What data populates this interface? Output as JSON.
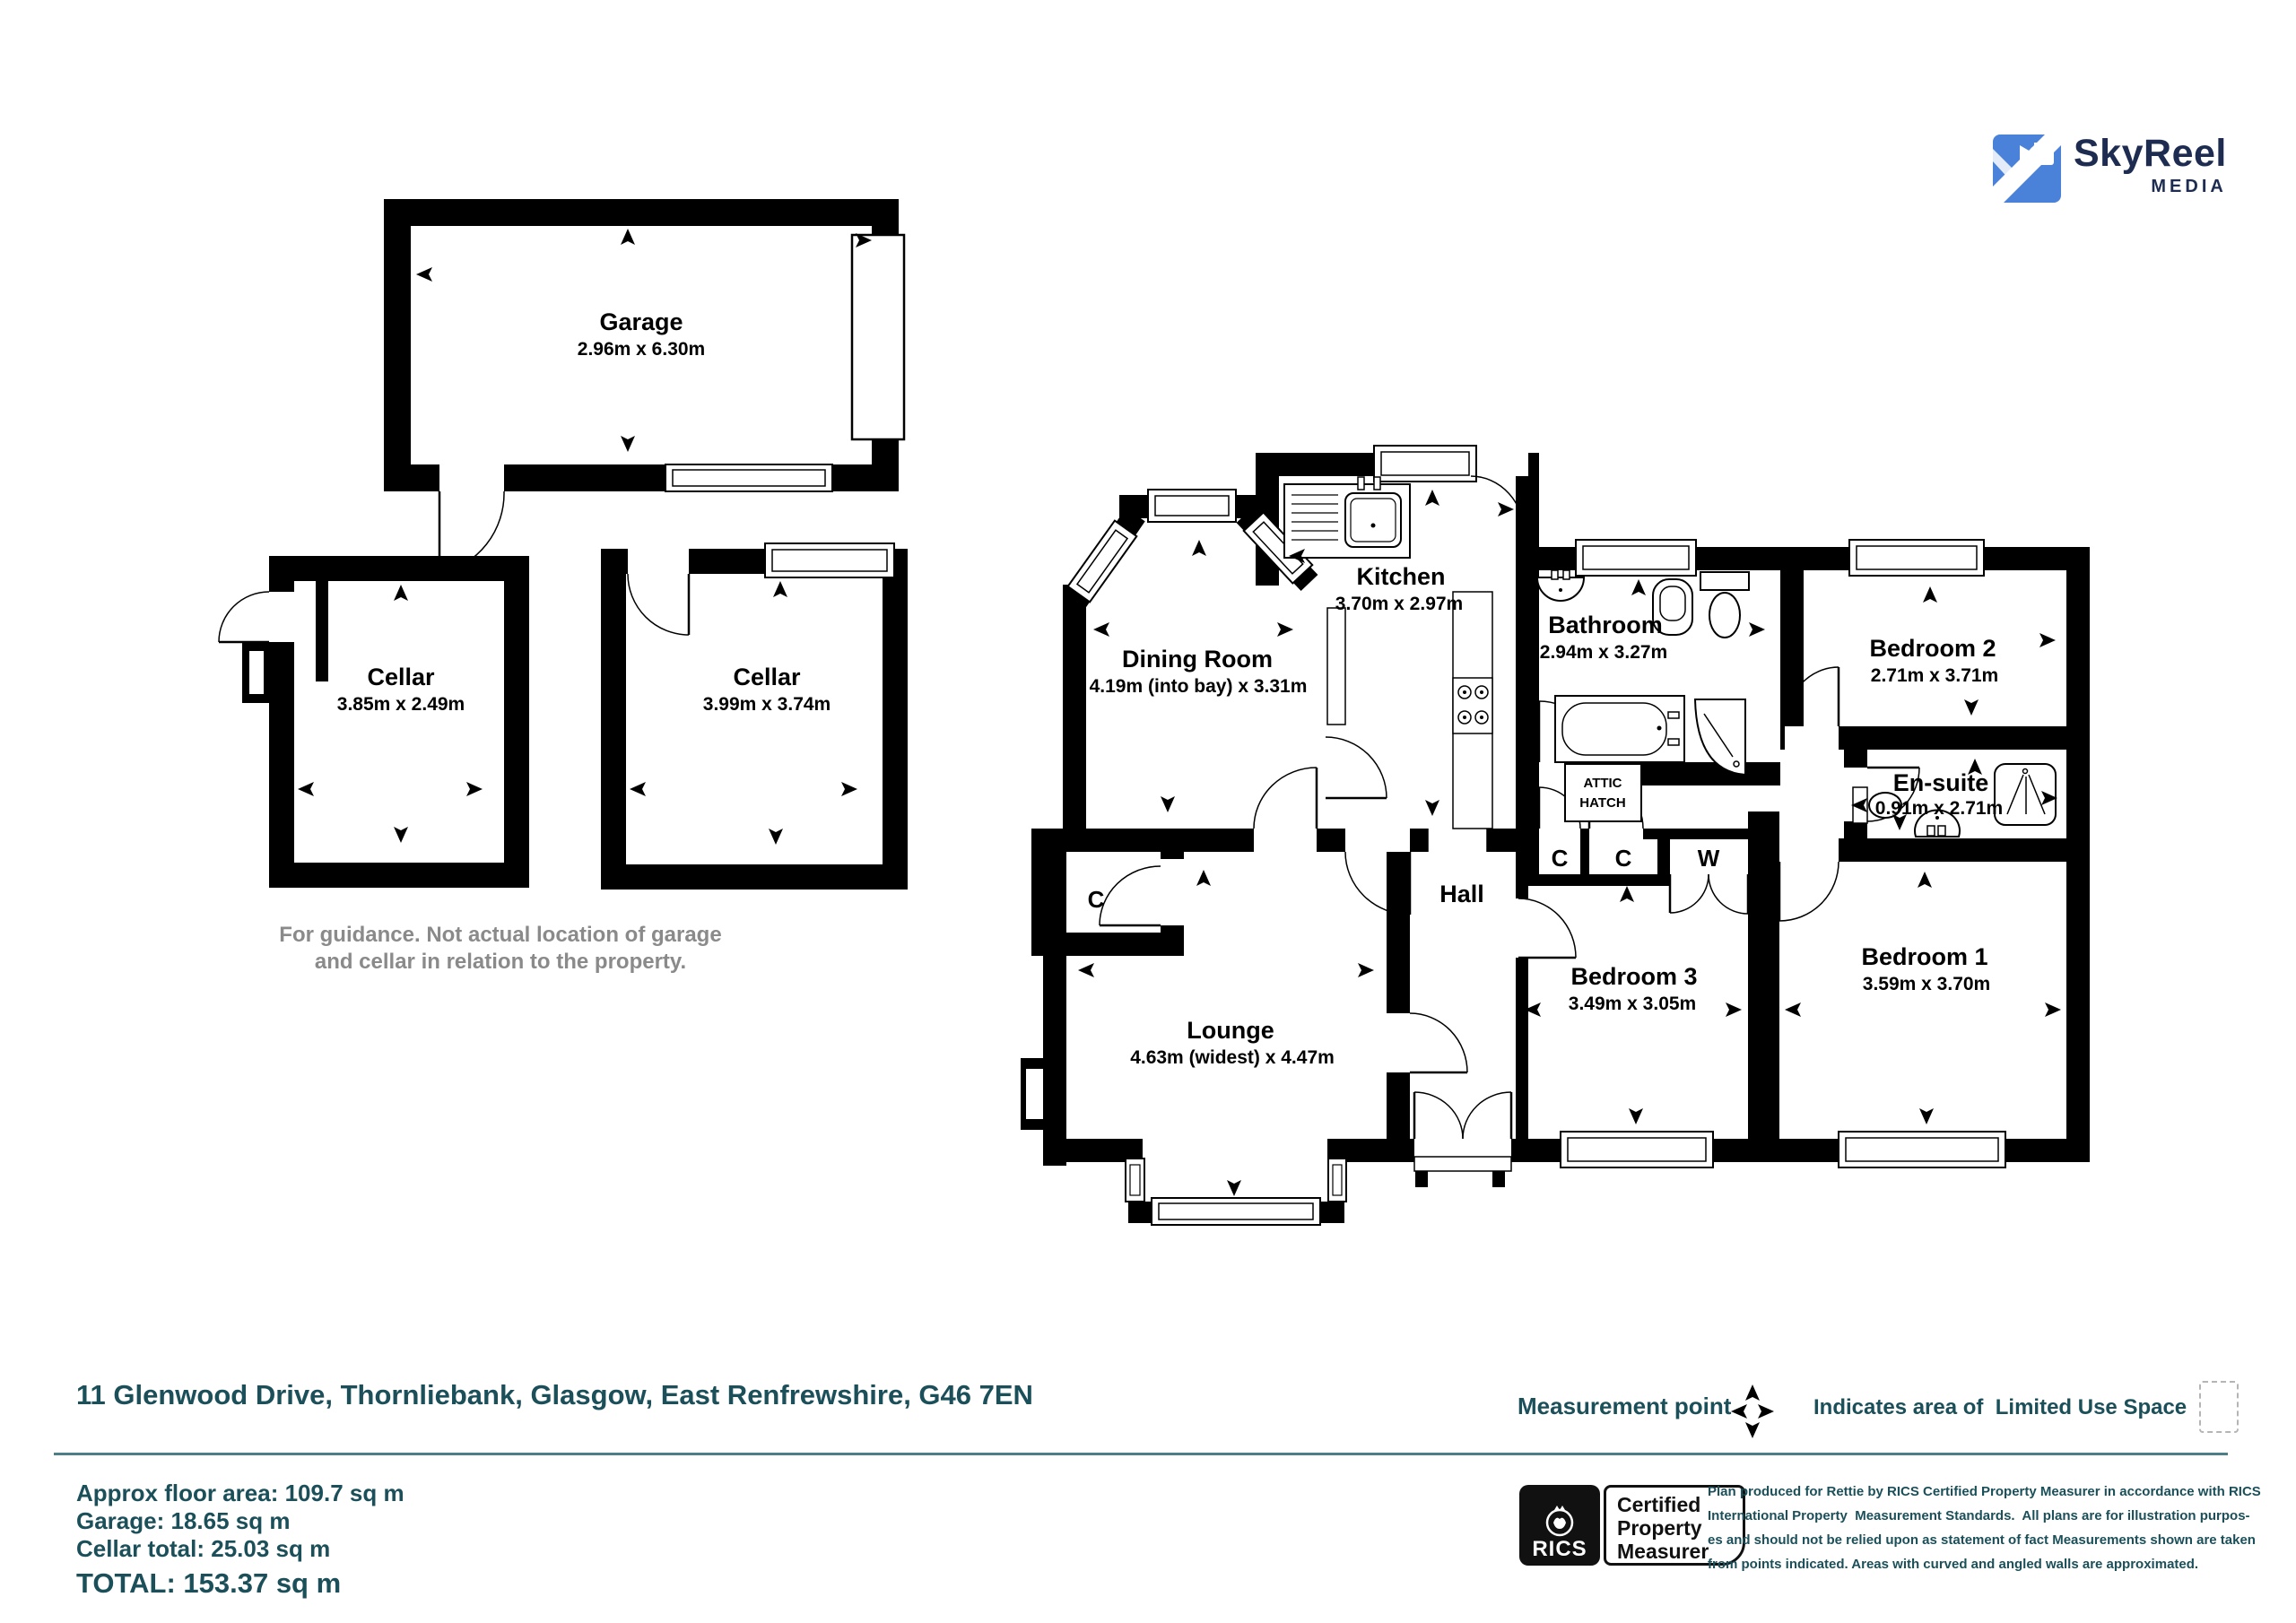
{
  "logo": {
    "brand": "SkyReel",
    "sub": "MEDIA"
  },
  "plan": {
    "garage": {
      "name": "Garage",
      "dims": "2.96m x 6.30m"
    },
    "cellar1": {
      "name": "Cellar",
      "dims": "3.85m x 2.49m"
    },
    "cellar2": {
      "name": "Cellar",
      "dims": "3.99m x 3.74m"
    },
    "dining": {
      "name": "Dining Room",
      "dims": "4.19m (into bay)  x 3.31m"
    },
    "kitchen": {
      "name": "Kitchen",
      "dims": "3.70m x 2.97m"
    },
    "bathroom": {
      "name": "Bathroom",
      "dims": "2.94m x 3.27m"
    },
    "bedroom2": {
      "name": "Bedroom 2",
      "dims": "2.71m x 3.71m"
    },
    "ensuite": {
      "name": "En-suite",
      "dims": "0.91m x 2.71m"
    },
    "hall": {
      "name": "Hall"
    },
    "lounge": {
      "name": "Lounge",
      "dims": "4.63m (widest) x 4.47m"
    },
    "bedroom3": {
      "name": "Bedroom 3",
      "dims": "3.49m x 3.05m"
    },
    "bedroom1": {
      "name": "Bedroom 1",
      "dims": "3.59m x 3.70m"
    },
    "closet_dining": "C",
    "closet1": "C",
    "closet2": "C",
    "wardrobe": "W",
    "attic": {
      "line1": "ATTIC",
      "line2": "HATCH"
    },
    "guidance": {
      "line1": "For guidance. Not actual location of garage",
      "line2": "and cellar in relation to the property."
    }
  },
  "address": "11 Glenwood Drive, Thornliebank, Glasgow, East Renfrewshire, G46 7EN",
  "legend": {
    "measurement_point": "Measurement point",
    "limited_use": "Indicates area of  Limited Use Space"
  },
  "areas": {
    "floor": "Approx floor area: 109.7 sq m",
    "garage": "Garage: 18.65 sq m",
    "cellar": "Cellar total: 25.03 sq m",
    "total": "TOTAL: 153.37 sq m"
  },
  "rics": {
    "brand": "RICS",
    "label_line1": "Certified",
    "label_line2": "Property",
    "label_line3": "Measurer"
  },
  "disclaimer": {
    "line1": "Plan produced for Rettie by RICS Certified Property Measurer in accordance with RICS",
    "line2": "International Property  Measurement Standards.  All plans are for illustration purpos-",
    "line3": "es and should not be relied upon as statement of fact Measurements shown are taken",
    "line4": "from points indicated. Areas with curved and angled walls are approximated."
  },
  "colors": {
    "teal": "#1b4f59",
    "logo_blue": "#4a81d9",
    "logo_navy": "#1d2c50",
    "note_gray": "#8a8a8a"
  }
}
